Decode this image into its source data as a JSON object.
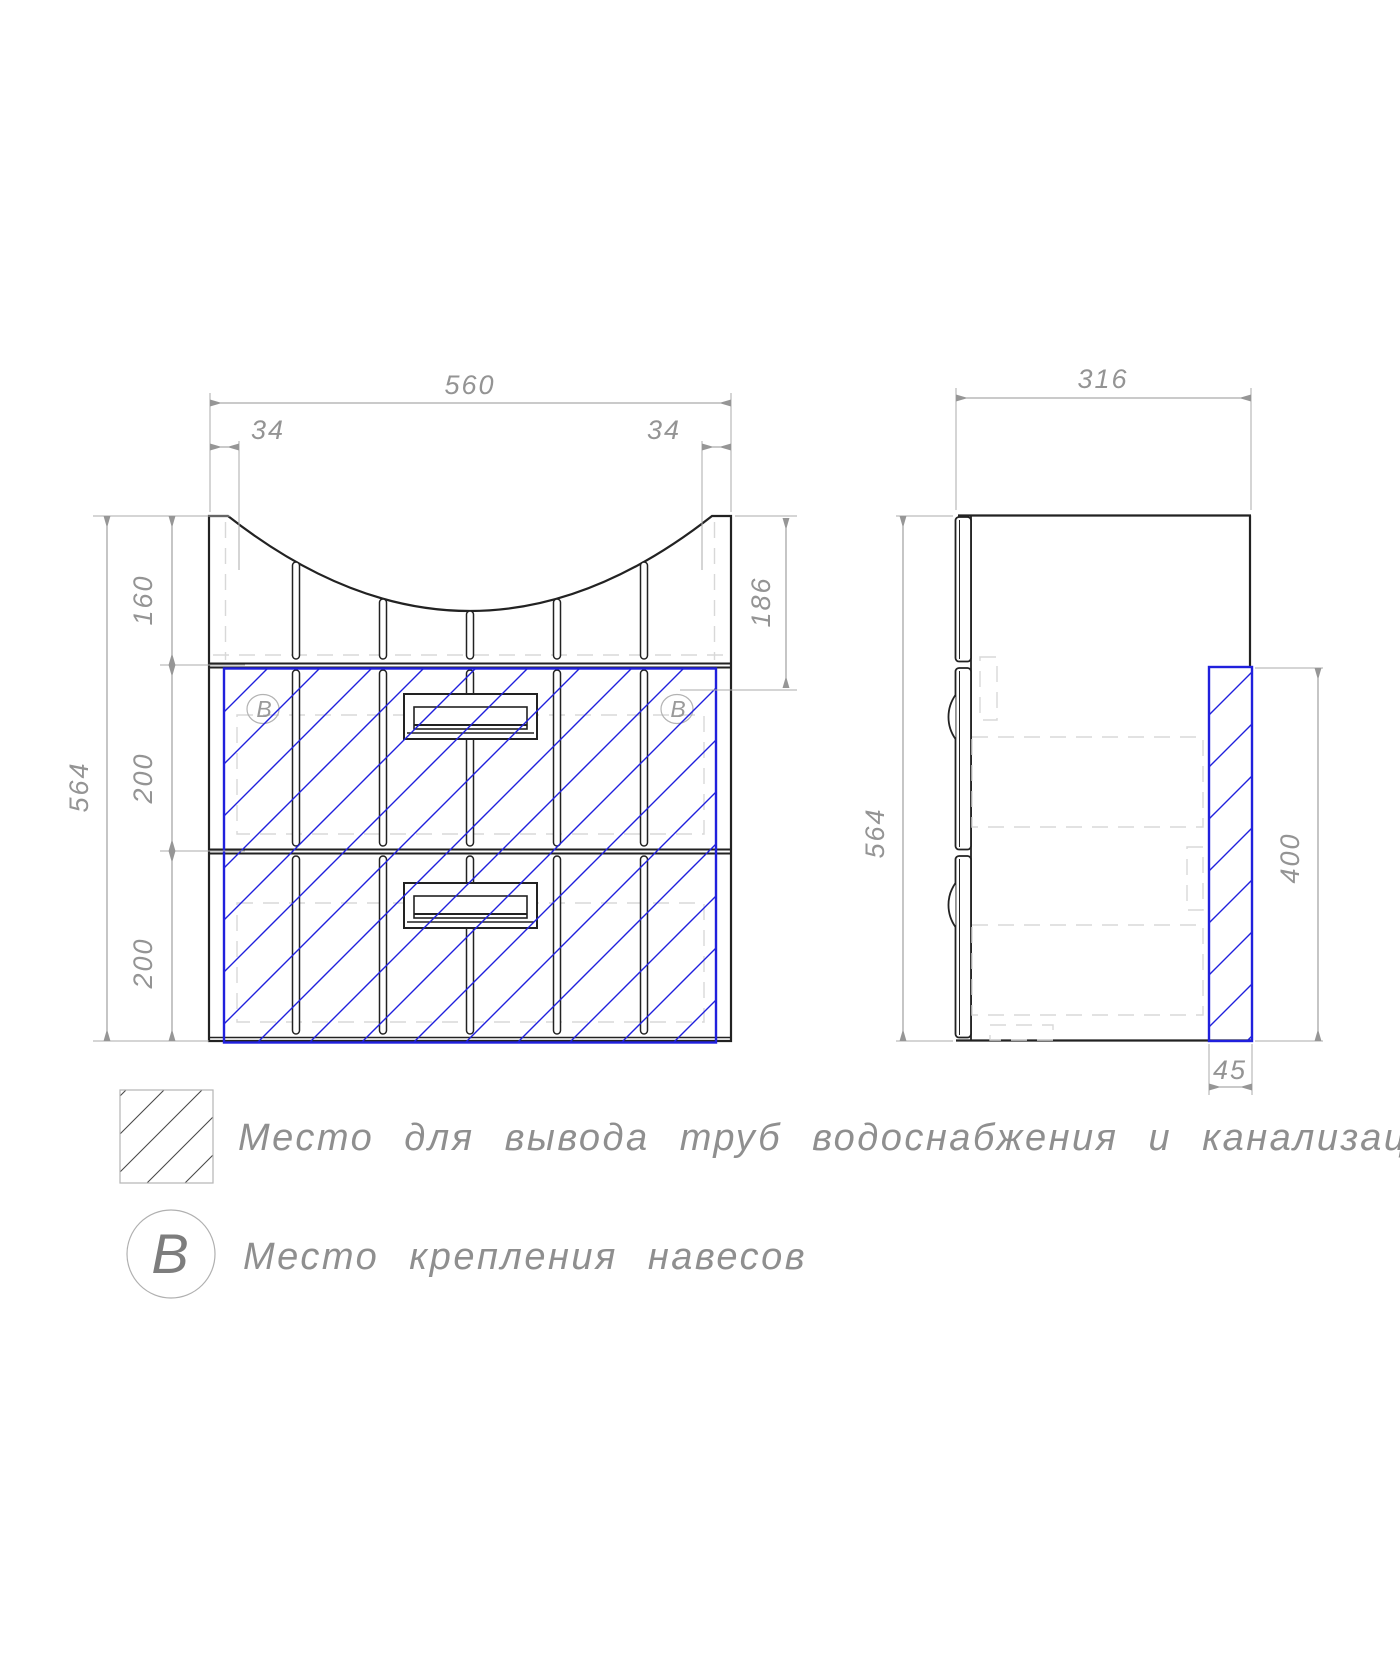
{
  "front_view": {
    "dim_width": "560",
    "dim_offset_left": "34",
    "dim_offset_right": "34",
    "dim_top_section_height": "160",
    "dim_upper_drawer_height": "200",
    "dim_lower_drawer_height": "200",
    "dim_total_height": "564",
    "dim_top_inner_depth": "186",
    "marker_left": "B",
    "marker_right": "B"
  },
  "side_view": {
    "dim_depth": "316",
    "dim_total_height": "564",
    "dim_pipe_zone_height": "400",
    "dim_pipe_zone_width": "45"
  },
  "legend": {
    "pipe_zone_label": "Место для вывода труб водоснабжения и канализации",
    "mount_symbol": "B",
    "mount_label": "Место крепления навесов"
  },
  "colors": {
    "outline": "#222222",
    "dimension": "#969696",
    "extension": "#ababab",
    "hidden": "#d8d8d8",
    "accent": "#2020dd",
    "legend_hatch": "#4a4a4a"
  }
}
